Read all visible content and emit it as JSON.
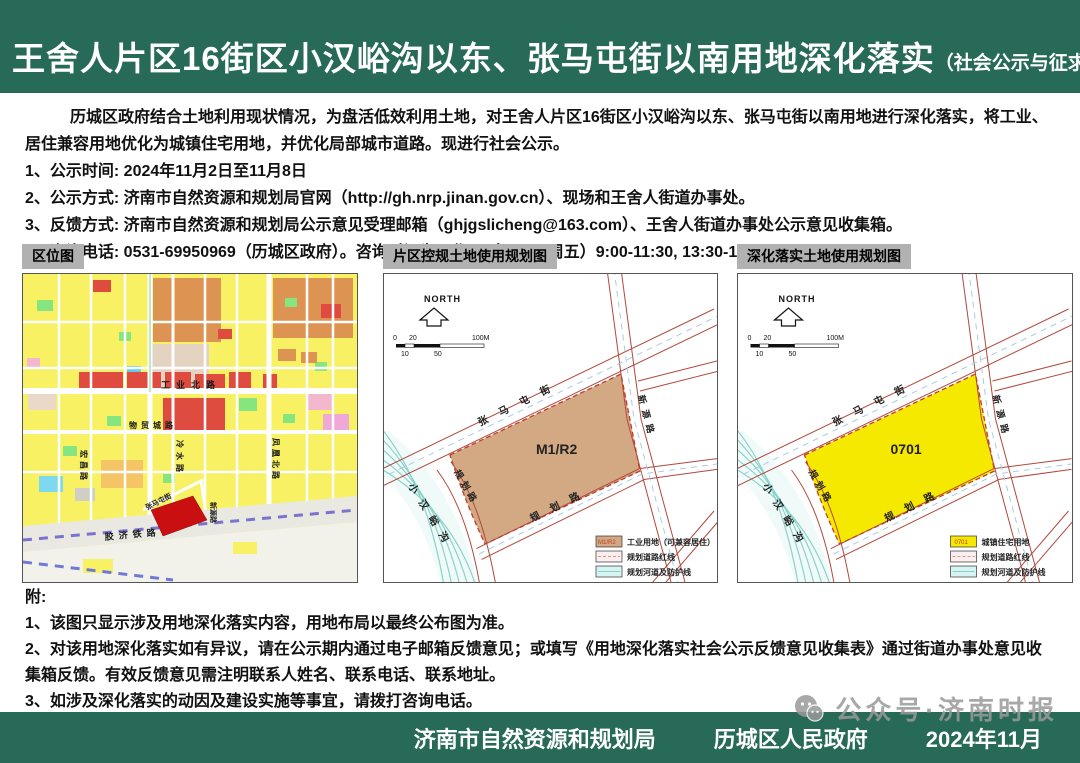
{
  "header": {
    "title": "王舍人片区16街区小汉峪沟以东、张马屯街以南用地深化落实",
    "subtitle": "（社会公示与征求意见）"
  },
  "intro": {
    "paragraph": "历城区政府结合土地利用现状情况，为盘活低效利用土地，对王舍人片区16街区小汉峪沟以东、张马屯街以南用地进行深化落实，将工业、居住兼容用地优化为城镇住宅用地，并优化局部城市道路。现进行社会公示。",
    "items": [
      "1、公示时间: 2024年11月2日至11月8日",
      "2、公示方式: 济南市自然资源和规划局官网（http://gh.nrp.jinan.gov.cn）、现场和王舍人街道办事处。",
      "3、反馈方式: 济南市自然资源和规划局公示意见受理邮箱（ghjgslicheng@163.com）、王舍人街道办事处公示意见收集箱。",
      "4、咨询电话: 0531-69950969（历城区政府）。咨询时间为工作日（周一至周五）9:00-11:30, 13:30-17:00。"
    ]
  },
  "maps": {
    "location": {
      "title": "区位图",
      "roads": {
        "gongyebei": "工业北路",
        "wumaocheng": "物贸城路",
        "lengshui": "冷水路",
        "fenghuangbei": "凤凰北路",
        "hongchang": "宏昌路",
        "xinyuan": "新源路",
        "zhangmatun": "张马屯街",
        "jiaoji": "胶济铁路"
      }
    },
    "control": {
      "title": "片区控规土地使用规划图",
      "north": "NORTH",
      "scale": {
        "t0": "0",
        "t20": "20",
        "t100": "100M",
        "b10": "10",
        "b50": "50"
      },
      "parcel_label": "M1/R2",
      "roads": {
        "zhangmatun": "张马屯街",
        "xinyuan": "新源路",
        "guihua_left": "规划路",
        "guihua_bottom": "规划路",
        "channel": "小汉峪沟"
      },
      "legend": [
        {
          "swatch": "M1/R2",
          "label": "工业用地（可兼容居住）"
        },
        {
          "swatch": "",
          "label": "规划道路红线"
        },
        {
          "swatch": "",
          "label": "规划河道及防护线"
        }
      ]
    },
    "detail": {
      "title": "深化落实土地使用规划图",
      "north": "NORTH",
      "scale": {
        "t0": "0",
        "t20": "20",
        "t100": "100M",
        "b10": "10",
        "b50": "50"
      },
      "parcel_label": "0701",
      "roads": {
        "zhangmatun": "张马屯街",
        "xinyuan": "新源路",
        "guihua_left": "规划路",
        "guihua_bottom": "规划路",
        "channel": "小汉峪沟"
      },
      "legend": [
        {
          "swatch": "0701",
          "label": "城镇住宅用地"
        },
        {
          "swatch": "",
          "label": "规划道路红线"
        },
        {
          "swatch": "",
          "label": "规划河道及防护线"
        }
      ]
    }
  },
  "notes": {
    "heading": "附:",
    "items": [
      "1、该图只显示涉及用地深化落实内容，用地布局以最终公布图为准。",
      "2、对该用地深化落实如有异议，请在公示期内通过电子邮箱反馈意见；或填写《用地深化落实社会公示反馈意见收集表》通过街道办事处意见收集箱反馈。有效反馈意见需注明联系人姓名、联系电话、联系地址。",
      "3、如涉及深化落实的动因及建设实施等事宜，请拨打咨询电话。",
      "4、公示意见收集、采纳情况及深化最终方案将通过济南市自然资源和规划局官网进行公告。"
    ]
  },
  "footer": {
    "org1": "济南市自然资源和规划局",
    "org2": "历城区人民政府",
    "date": "2024年11月"
  },
  "watermark": {
    "text": "公众号·济南时报"
  },
  "colors": {
    "header_green": "#276a58",
    "industrial_tan": "#d2a983",
    "residential_yellow": "#f5e900",
    "highlight_red": "#c90f0f"
  }
}
